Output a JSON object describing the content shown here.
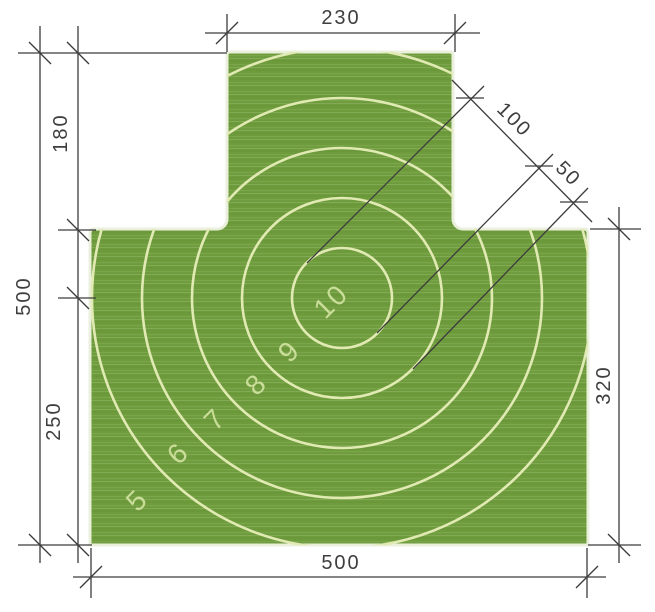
{
  "drawing": {
    "title": "shooting-target-dimensioned-drawing",
    "dimensions": {
      "top_width": "230",
      "left_upper": "180",
      "left_total": "500",
      "left_lower": "250",
      "bottom_width": "500",
      "right_height": "320",
      "inner_ring_diameter": "100",
      "ring_spacing": "50"
    },
    "rings": [
      {
        "label": "10"
      },
      {
        "label": "9"
      },
      {
        "label": "8"
      },
      {
        "label": "7"
      },
      {
        "label": "6"
      },
      {
        "label": "5"
      }
    ],
    "colors": {
      "target_green": "#6e9b3c",
      "target_green_light": "#7ba54b",
      "ring_line": "#e0eab2",
      "ring_text": "#c9dd99",
      "outline": "#eaf0dc",
      "dimension": "#3c3c3c",
      "background": "#ffffff"
    }
  }
}
